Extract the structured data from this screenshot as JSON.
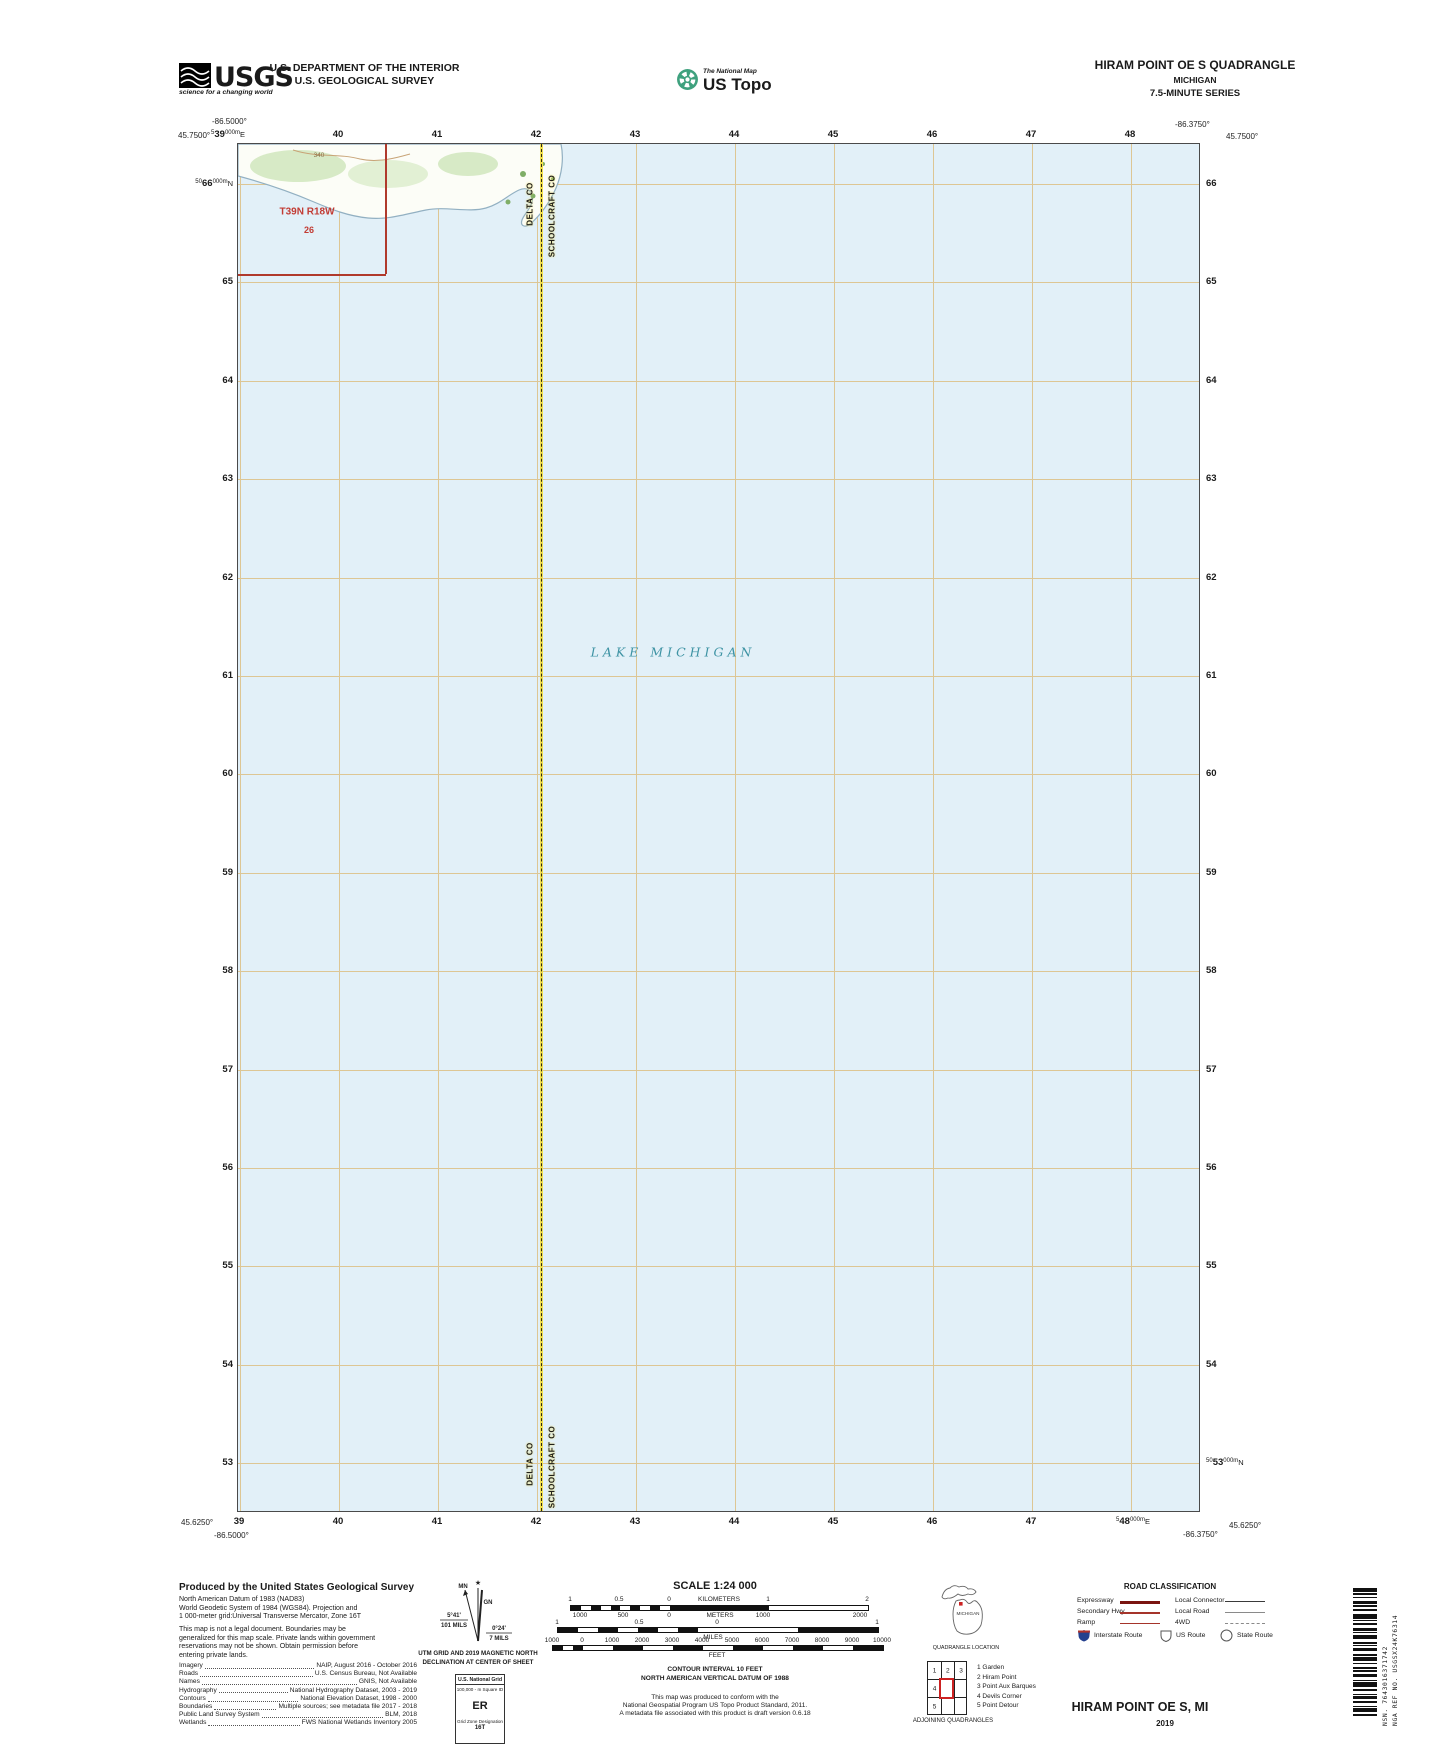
{
  "header": {
    "usgs_logo": {
      "text": "USGS",
      "tagline": "science for a changing world"
    },
    "dept_line1": "U.S. DEPARTMENT OF THE INTERIOR",
    "dept_line2": "U.S. GEOLOGICAL SURVEY",
    "ustopo": {
      "brand_top": "The National Map",
      "brand": "US Topo"
    },
    "quad": {
      "title": "HIRAM POINT OE S QUADRANGLE",
      "state": "MICHIGAN",
      "series": "7.5-MINUTE SERIES"
    }
  },
  "map": {
    "corners": {
      "tl_lon": "-86.5000°",
      "tl_lat": "45.7500°",
      "tr_lon": "-86.3750°",
      "tr_lat": "45.7500°",
      "bl_lat": "45.6250°",
      "bl_lon": "-86.5000°",
      "br_lon": "-86.3750°",
      "br_lat": "45.6250°"
    },
    "grid": {
      "top": [
        {
          "pre": "5",
          "main": "39",
          "sup": "000m",
          "suf": "E"
        },
        "40",
        "41",
        "42",
        "43",
        "44",
        "45",
        "46",
        "47",
        "48"
      ],
      "bottom": [
        "39",
        "40",
        "41",
        "42",
        "43",
        "44",
        "45",
        "46",
        "47",
        {
          "pre": "5",
          "main": "48",
          "sup": "000m",
          "suf": "E"
        }
      ],
      "left": [
        {
          "pre": "50",
          "main": "66",
          "sup": "000m",
          "suf": "N"
        },
        "65",
        "64",
        "63",
        "62",
        "61",
        "60",
        "59",
        "58",
        "57",
        "56",
        "55",
        "54",
        "53"
      ],
      "right": [
        "66",
        "65",
        "64",
        "63",
        "62",
        "61",
        "60",
        "59",
        "58",
        "57",
        "56",
        "55",
        "54",
        {
          "pre": "50",
          "main": "53",
          "sup": "000m",
          "suf": "N"
        }
      ]
    },
    "labels": {
      "lake": "LAKE MICHIGAN",
      "township": "T39N R18W",
      "section": "26",
      "contour": "340",
      "county_left": "DELTA CO",
      "county_right": "SCHOOLCRAFT CO"
    },
    "colors": {
      "water": "#e2f0f8",
      "grid_line": "#ddc694",
      "county_yellow": "#f2e04f",
      "boundary_red": "#b03a2c",
      "lake_label": "#3e93a4"
    }
  },
  "footer": {
    "produced": {
      "heading": "Produced by the United States Geological Survey",
      "datum_lines": [
        "North American Datum of 1983 (NAD83)",
        "World Geodetic System of 1984 (WGS84).  Projection and",
        "1 000-meter grid:Universal Transverse Mercator, Zone 16T"
      ],
      "legal_lines": [
        "This map is not a legal document. Boundaries may be",
        "generalized for this map scale. Private lands within government",
        "reservations may not be shown. Obtain permission before",
        "entering private lands."
      ],
      "credits": [
        {
          "label": "Imagery",
          "value": "NAIP, August 2016 - October 2016"
        },
        {
          "label": "Roads",
          "value": "U.S. Census Bureau, Not Available"
        },
        {
          "label": "Names",
          "value": "GNIS, Not Available"
        },
        {
          "label": "Hydrography",
          "value": "National Hydrography Dataset, 2003 - 2019"
        },
        {
          "label": "Contours",
          "value": "National Elevation Dataset, 1998 - 2000"
        },
        {
          "label": "Boundaries",
          "value": "Multiple sources; see metadata file 2017 - 2018"
        },
        {
          "label": "Public Land Survey System",
          "value": "BLM, 2018"
        },
        {
          "label": "Wetlands",
          "value": "FWS National Wetlands Inventory 2005"
        }
      ]
    },
    "declination": {
      "star": "★",
      "mn_label": "MN",
      "gn_label": "GN",
      "left_deg": "5°41'",
      "left_mils": "101 MILS",
      "right_deg": "0°24'",
      "right_mils": "7 MILS",
      "note1": "UTM GRID AND 2019 MAGNETIC NORTH",
      "note2": "DECLINATION AT CENTER OF SHEET"
    },
    "usng": {
      "title": "U.S. National Grid",
      "subtitle": "100,000 - m Square ID",
      "square_id": "ER",
      "gzd_label": "Grid Zone Designation",
      "zone": "16T"
    },
    "scale": {
      "title": "SCALE 1:24 000",
      "km": {
        "labels": [
          "1",
          "0.5",
          "0",
          "1",
          "2"
        ],
        "unit": "KILOMETERS"
      },
      "m": {
        "labels": [
          "1000",
          "500",
          "0",
          "1000",
          "2000"
        ],
        "unit": "METERS"
      },
      "mi": {
        "labels": [
          "1",
          "0.5",
          "0",
          "1"
        ],
        "unit": "MILES"
      },
      "ft": {
        "labels": [
          "1000",
          "0",
          "1000",
          "2000",
          "3000",
          "4000",
          "5000",
          "6000",
          "7000",
          "8000",
          "9000",
          "10000"
        ],
        "unit": "FEET"
      }
    },
    "notes": {
      "contour1": "CONTOUR INTERVAL 10 FEET",
      "contour2": "NORTH AMERICAN VERTICAL DATUM OF 1988",
      "std1": "This map was produced to conform with the",
      "std2": "National Geospatial Program US Topo Product Standard, 2011.",
      "std3": "A metadata file associated with this product is draft version 0.6.18"
    },
    "location": {
      "state": "MICHIGAN",
      "caption": "QUADRANGLE LOCATION"
    },
    "adjoining": {
      "caption": "ADJOINING QUADRANGLES",
      "cells": [
        "1",
        "2",
        "3",
        "4",
        "5"
      ],
      "legend": [
        "1 Garden",
        "2 Hiram Point",
        "3 Point Aux Barques",
        "4 Devils Corner",
        "5 Point Detour"
      ]
    },
    "roads": {
      "title": "ROAD CLASSIFICATION",
      "rows": [
        {
          "left": "Expressway",
          "right": "Local Connector"
        },
        {
          "left": "Secondary Hwy",
          "right": "Local Road"
        },
        {
          "left": "Ramp",
          "right": "4WD"
        }
      ],
      "shields": [
        "Interstate Route",
        "US Route",
        "State Route"
      ]
    },
    "title_block": {
      "name": "HIRAM POINT OE S,  MI",
      "year": "2019"
    },
    "barcode": {
      "nsn": "NSN. 7643016371742",
      "nga": "NGA REF NO. USGSX24K76314"
    }
  }
}
